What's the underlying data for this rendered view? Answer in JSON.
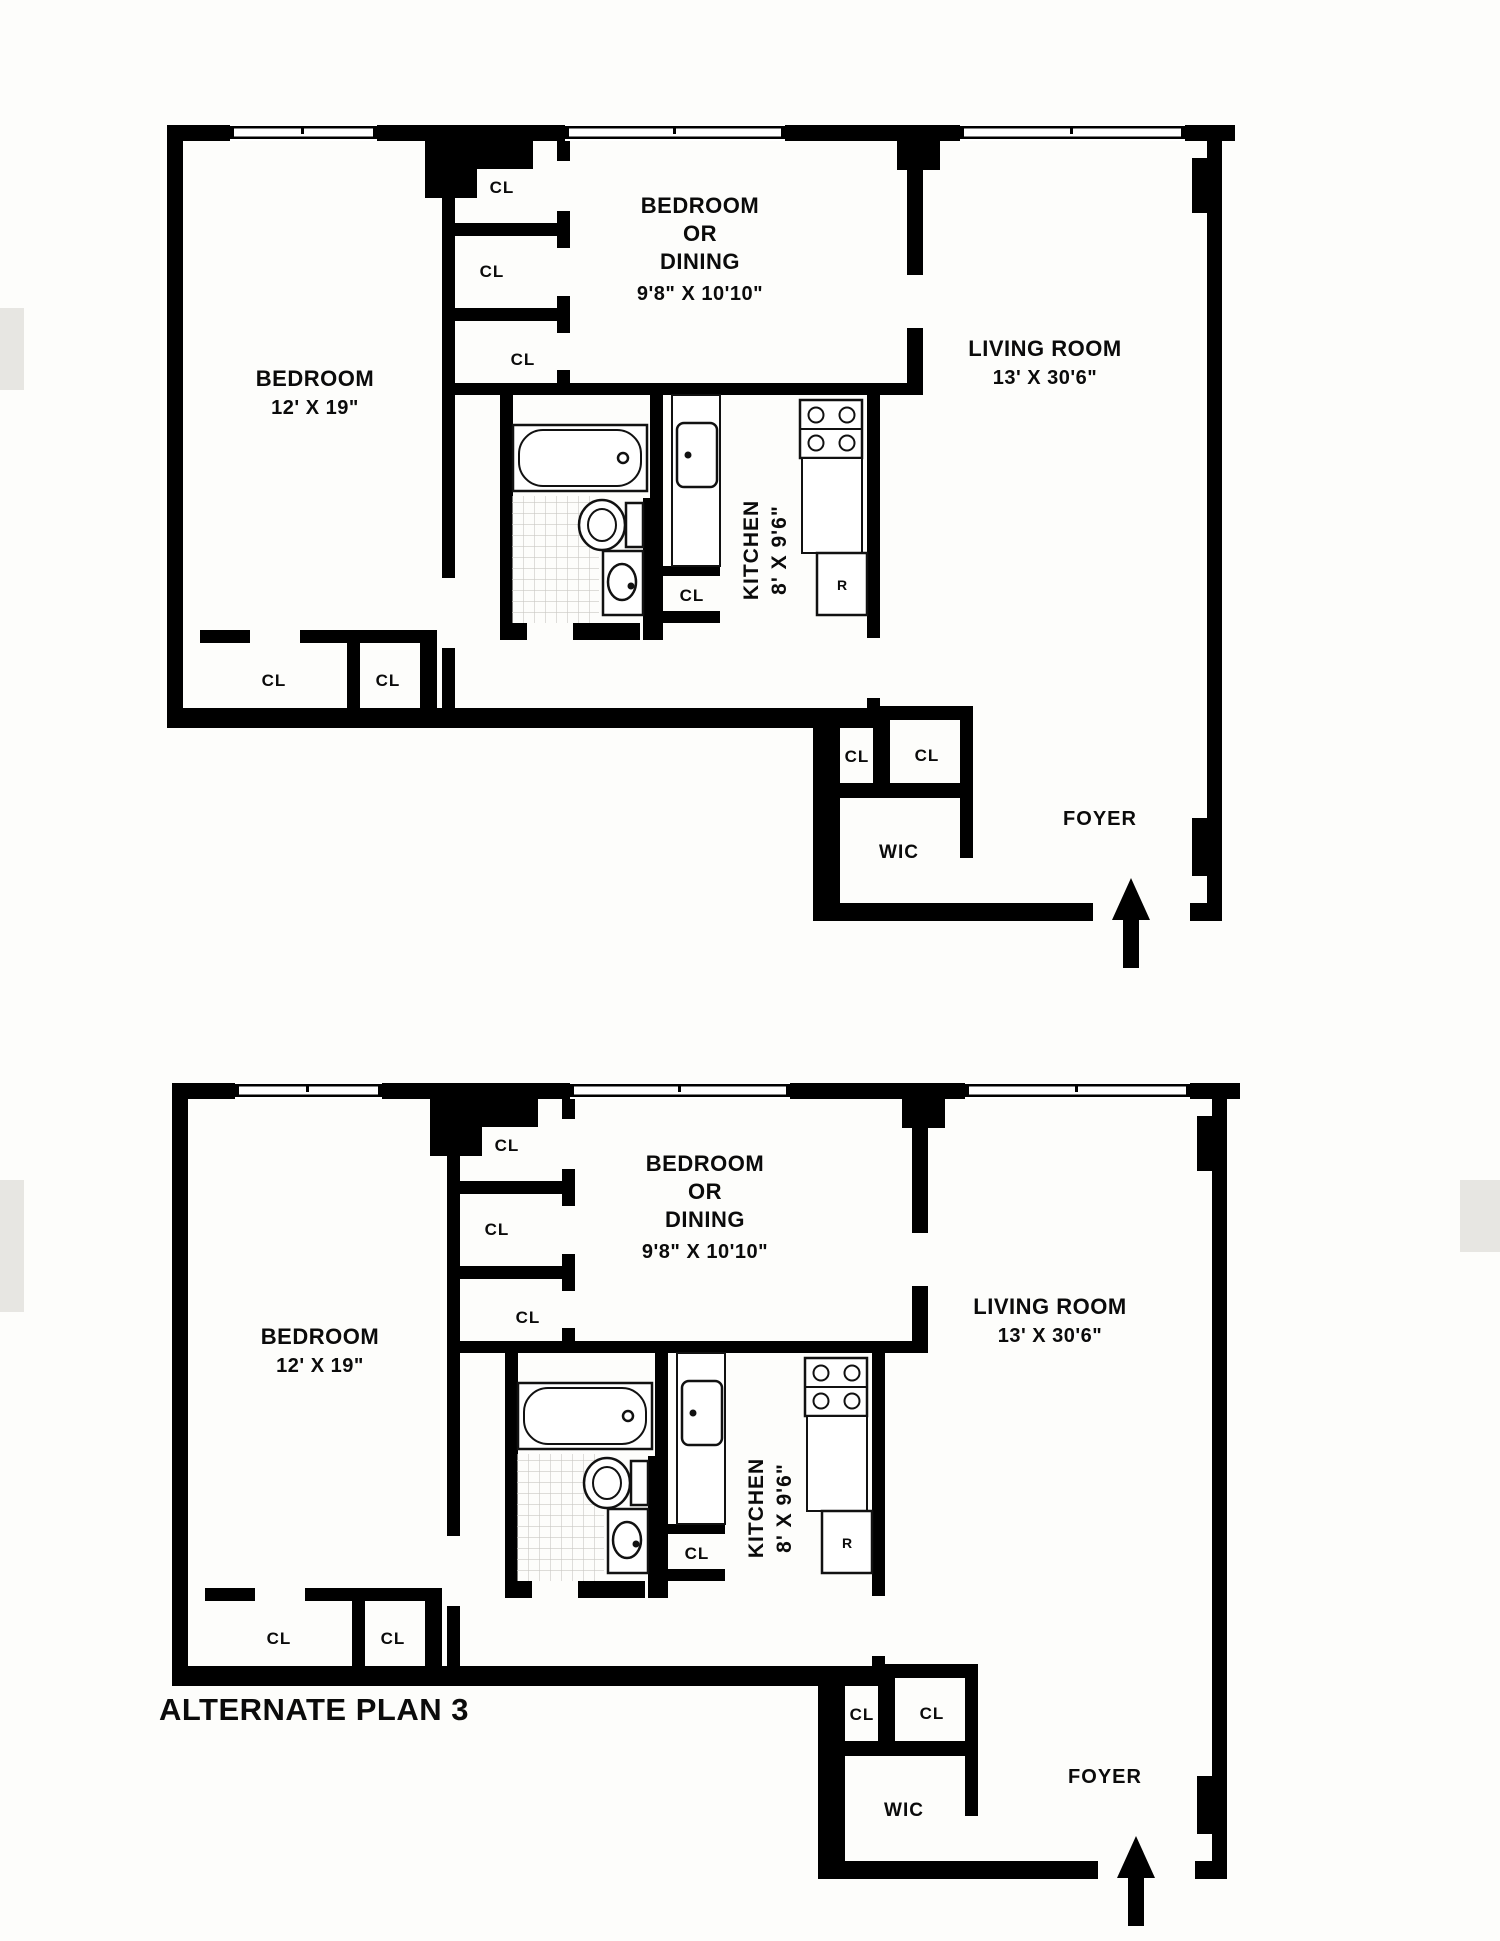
{
  "background": {
    "page_color": "#fdfdfb",
    "wall_color": "#000000",
    "tile_line_color": "#c9c8c4",
    "scan_artifact_color": "#e7e6e2"
  },
  "plans": [
    {
      "id": "floor-plan-1",
      "caption": "",
      "rooms": {
        "bedroom": {
          "name": "BEDROOM",
          "dims": "12' X 19\""
        },
        "bedroom_or_dining": {
          "line1": "BEDROOM",
          "line2": "OR",
          "line3": "DINING",
          "dims": "9'8\" X 10'10\""
        },
        "living_room": {
          "name": "LIVING ROOM",
          "dims": "13' X 30'6\""
        },
        "kitchen": {
          "name": "KITCHEN",
          "dims": "8' X 9'6\""
        },
        "wic": {
          "name": "WIC"
        },
        "foyer": {
          "name": "FOYER"
        }
      },
      "closets": {
        "column": [
          "CL",
          "CL",
          "CL"
        ],
        "bedroom": [
          "CL",
          "CL"
        ],
        "kitchen": "CL",
        "foyer": [
          "CL",
          "CL"
        ]
      },
      "appliances": {
        "refrigerator": "R"
      }
    },
    {
      "id": "floor-plan-2-alternate",
      "caption": "ALTERNATE PLAN 3",
      "rooms": {
        "bedroom": {
          "name": "BEDROOM",
          "dims": "12' X 19\""
        },
        "bedroom_or_dining": {
          "line1": "BEDROOM",
          "line2": "OR",
          "line3": "DINING",
          "dims": "9'8\" X 10'10\""
        },
        "living_room": {
          "name": "LIVING ROOM",
          "dims": "13' X 30'6\""
        },
        "kitchen": {
          "name": "KITCHEN",
          "dims": "8' X 9'6\""
        },
        "wic": {
          "name": "WIC"
        },
        "foyer": {
          "name": "FOYER"
        }
      },
      "closets": {
        "column": [
          "CL",
          "CL",
          "CL"
        ],
        "bedroom": [
          "CL",
          "CL"
        ],
        "kitchen": "CL",
        "foyer": [
          "CL",
          "CL"
        ]
      },
      "appliances": {
        "refrigerator": "R"
      }
    }
  ]
}
